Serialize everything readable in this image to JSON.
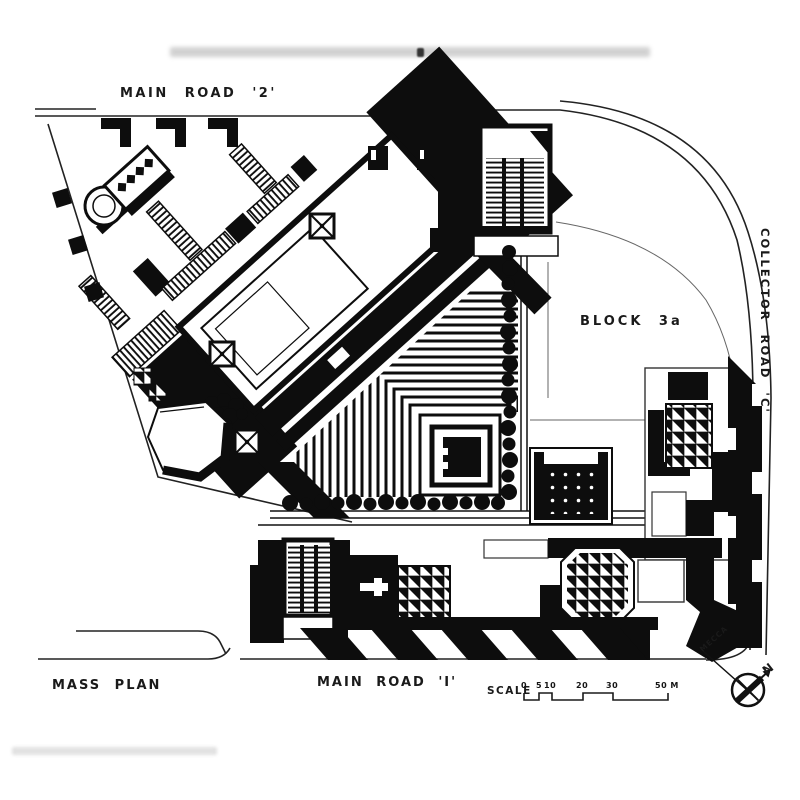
{
  "drawing_title": "MASS PLAN",
  "colors": {
    "ink": "#0d0d0d",
    "paper": "#ffffff"
  },
  "labels": {
    "main_road_2": "MAIN ROAD '2'",
    "collector_road_c": "COLLECTOR ROAD 'C'",
    "block_3a": "BLOCK 3a",
    "main_road_1": "MAIN ROAD 'I'",
    "mass_plan": "MASS PLAN"
  },
  "scale_bar": {
    "label": "SCALE",
    "ticks": [
      "0",
      "5",
      "10",
      "20",
      "30",
      "50 M"
    ]
  },
  "compass": {
    "mecca": "MECCA",
    "north": "N"
  }
}
